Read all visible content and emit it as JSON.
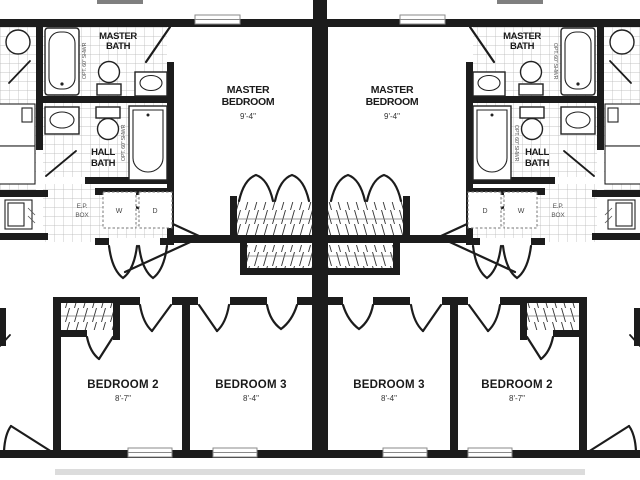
{
  "title": "Duplex floor plan",
  "colors": {
    "wall": "#1c1c1c",
    "tile_line": "#b3b3b3",
    "shadow": "#dcdcdc",
    "text": "#1a1a1a",
    "note_text": "#555555"
  },
  "rooms": {
    "master_bath": {
      "line1": "MASTER",
      "line2": "BATH"
    },
    "hall_bath": {
      "line1": "HALL",
      "line2": "BATH"
    },
    "master_bedroom": {
      "line1": "MASTER",
      "line2": "BEDROOM",
      "dim": "9'-4\""
    },
    "bedroom2": {
      "label": "BEDROOM 2",
      "dim": "8'-7\""
    },
    "bedroom3": {
      "label": "BEDROOM 3",
      "dim": "8'-4\""
    }
  },
  "labels": {
    "washer": "W",
    "dryer": "D",
    "ep_line1": "E.P.",
    "ep_line2": "BOX",
    "tub_note": "OPT. 60\" SHWR"
  }
}
